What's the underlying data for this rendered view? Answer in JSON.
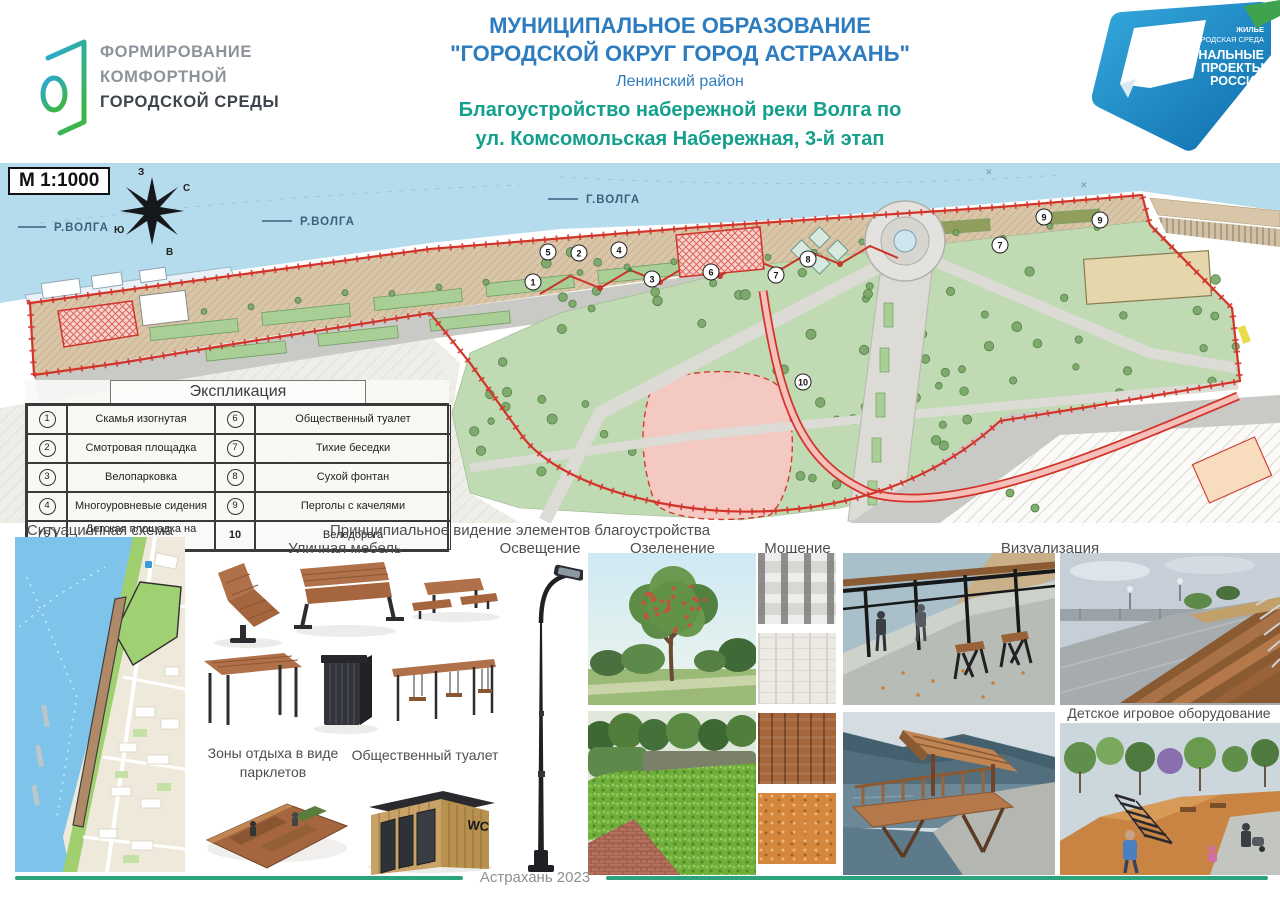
{
  "header": {
    "program_logo": {
      "line1": "ФОРМИРОВАНИЕ",
      "line2": "КОМФОРТНОЙ",
      "line3": "ГОРОДСКОЙ СРЕДЫ"
    },
    "title": {
      "line1": "МУНИЦИПАЛЬНОЕ ОБРАЗОВАНИЕ",
      "line2": "\"ГОРОДСКОЙ ОКРУГ ГОРОД АСТРАХАНЬ\"",
      "line3": "Ленинский район",
      "line4": "Благоустройство набережной реки Волга по",
      "line5": "ул. Комсомольская Набережная, 3-й этап"
    },
    "national_projects_logo": {
      "sector_line1": "ЖИЛЬЕ",
      "sector_line2": "И ГОРОДСКАЯ СРЕДА",
      "brand_line1": "НАЦИОНАЛЬНЫЕ",
      "brand_line2": "ПРОЕКТЫ",
      "brand_line3": "РОССИИ"
    }
  },
  "master_plan": {
    "scale_label": "М 1:1000",
    "river_labels": [
      "Р.ВОЛГА",
      "Р.ВОЛГА",
      "Г.ВОЛГА"
    ],
    "compass": {
      "top": "З",
      "upper_right": "С",
      "lower_left": "Ю",
      "lower_right": "В"
    },
    "markers": [
      "1",
      "2",
      "3",
      "4",
      "5",
      "6",
      "7",
      "8",
      "9",
      "10"
    ]
  },
  "legend": {
    "title": "Экспликация",
    "items": [
      {
        "num": "1",
        "label": "Скамья изогнутая"
      },
      {
        "num": "2",
        "label": "Смотровая площадка"
      },
      {
        "num": "3",
        "label": "Велопарковка"
      },
      {
        "num": "4",
        "label": "Многоуровневые сидения"
      },
      {
        "num": "5",
        "label": "Детская площадка на откосе"
      },
      {
        "num": "6",
        "label": "Общественный туалет"
      },
      {
        "num": "7",
        "label": "Тихие беседки"
      },
      {
        "num": "8",
        "label": "Сухой фонтан"
      },
      {
        "num": "9",
        "label": "Перголы с качелями"
      },
      {
        "num": "10",
        "label": "Велодорога"
      }
    ]
  },
  "sections": {
    "situational_scheme": "Ситуационная схема",
    "principal_vision": "Принципиальное видение элементов благоустройства",
    "street_furniture": "Уличная мебель",
    "parklets_line1": "Зоны отдыха в виде",
    "parklets_line2": "парклетов",
    "toilet": "Общественный туалет",
    "toilet_sign": "WC",
    "lighting": "Освещение",
    "greenery": "Озеленение",
    "paving": "Мощение",
    "visualization": "Визуализация",
    "kids_equipment": "Детское игровое оборудование"
  },
  "footer": {
    "text": "Астрахань 2023"
  },
  "colors": {
    "title_blue": "#2e7cc0",
    "title_teal": "#14a08d",
    "accent_green": "#2ba37c",
    "boundary_red": "#d2342a",
    "np_blue": "#1f8dc8",
    "np_green": "#3fa34d",
    "water": "#b5dcec"
  }
}
